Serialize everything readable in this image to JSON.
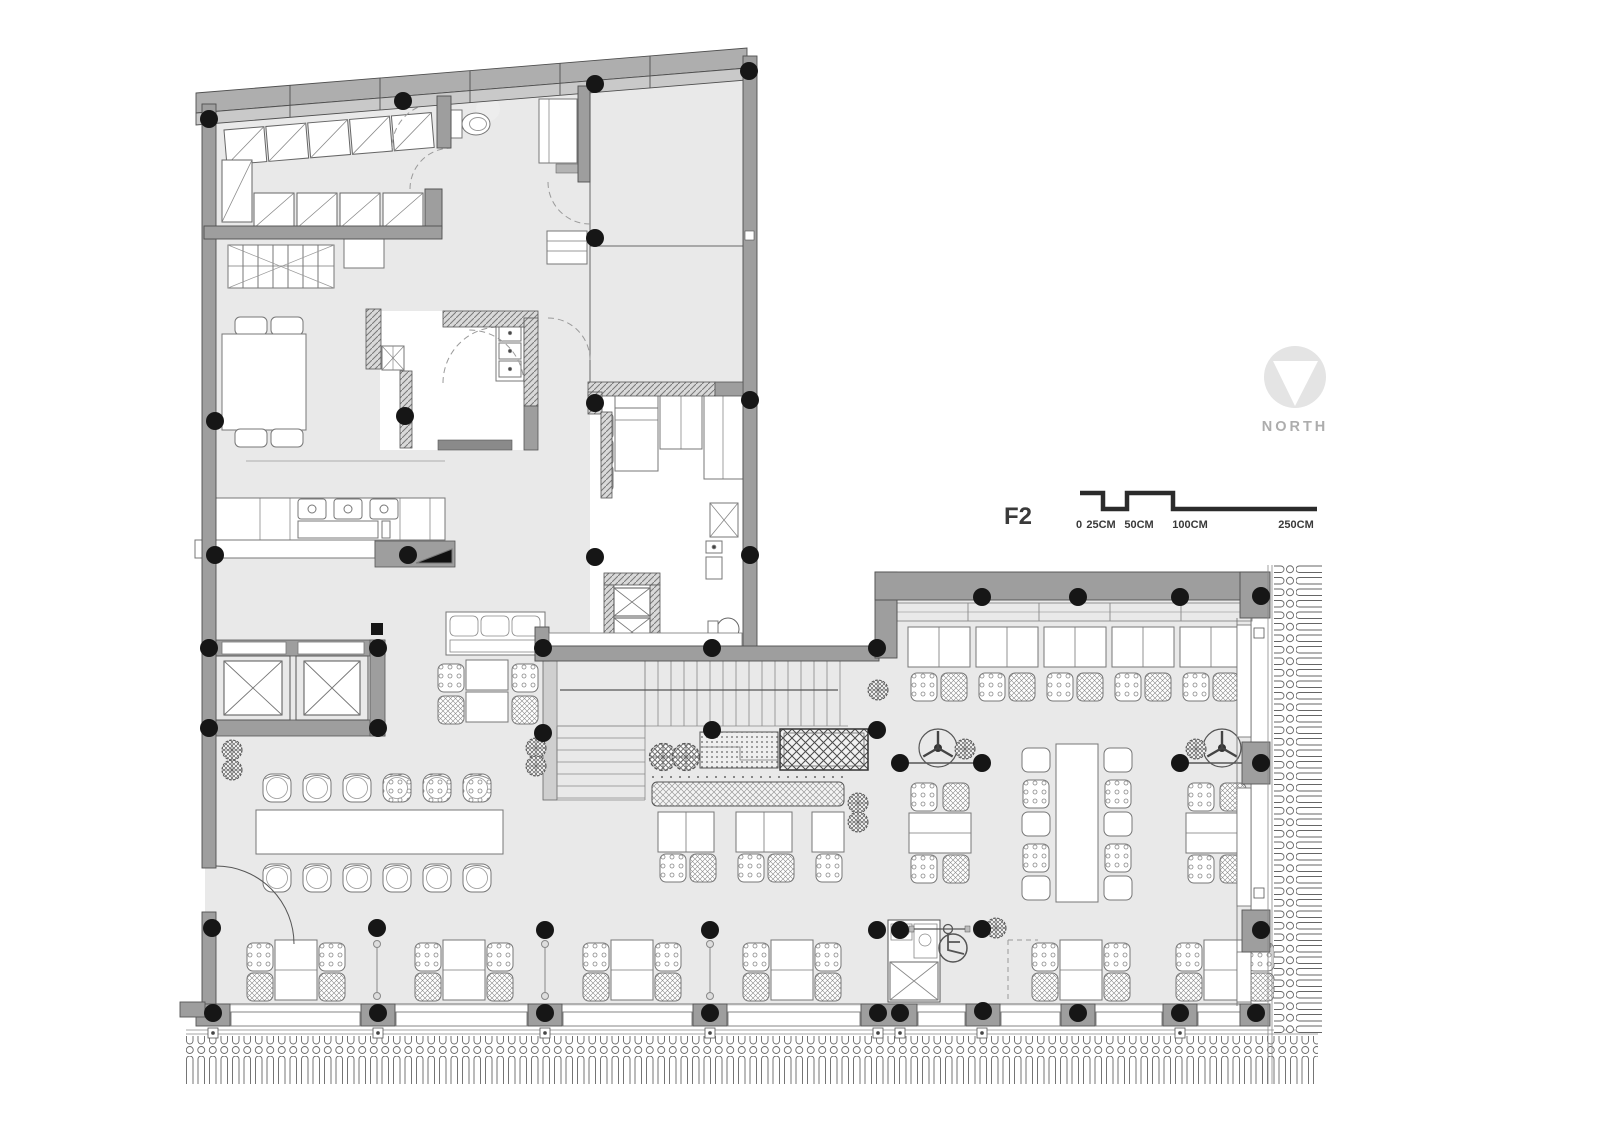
{
  "floor_label": {
    "text": "F2",
    "color": "#3a3a3a"
  },
  "north_indicator": {
    "label": "NORTH",
    "icon": "north-arrow-icon",
    "circle_color": "#e4e4e4",
    "triangle_color": "#ffffff",
    "text_color": "#adadad"
  },
  "scale_bar": {
    "labels": [
      "0",
      "25CM",
      "50CM",
      "100CM",
      "250CM"
    ],
    "bar_color": "#2b2b2b",
    "text_color": "#3a3a3a"
  },
  "palette": {
    "floor": "#e9e9e9",
    "wall": "#9e9e9e",
    "wall_band_outer": "#aeaeae",
    "wall_band_inner": "#c9c9c9",
    "column": "#161616",
    "outline": "#777777",
    "furniture": "#ffffff"
  },
  "icons": {
    "north": "north-arrow-icon",
    "toilet": "toilet-icon",
    "wheelchair": "wheelchair-icon",
    "fan": "ceiling-fan-icon",
    "plant": "plant-icon",
    "stairs": "stairs-icon",
    "elevator": "elevator-icon"
  }
}
